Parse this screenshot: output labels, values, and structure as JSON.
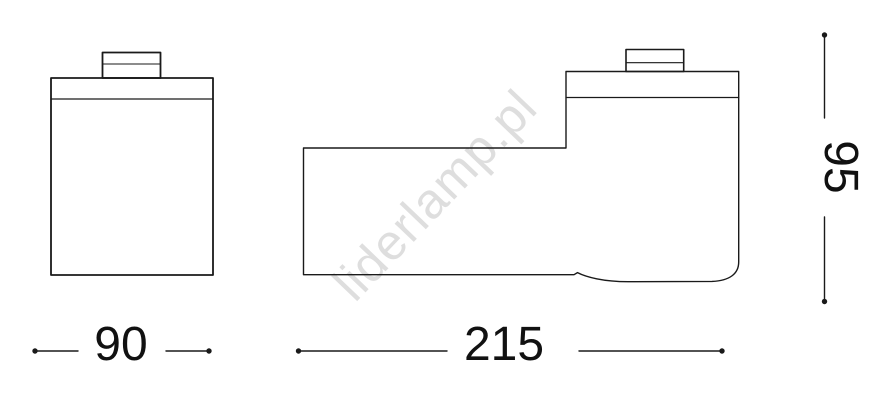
{
  "drawing": {
    "watermark_text": "liderlamp.pl",
    "dimensions": {
      "front_width": "90",
      "side_length": "215",
      "side_height": "95"
    },
    "colors": {
      "line": "#1a1a1a",
      "text": "#111111",
      "watermark": "#dedede",
      "background": "#ffffff"
    }
  }
}
